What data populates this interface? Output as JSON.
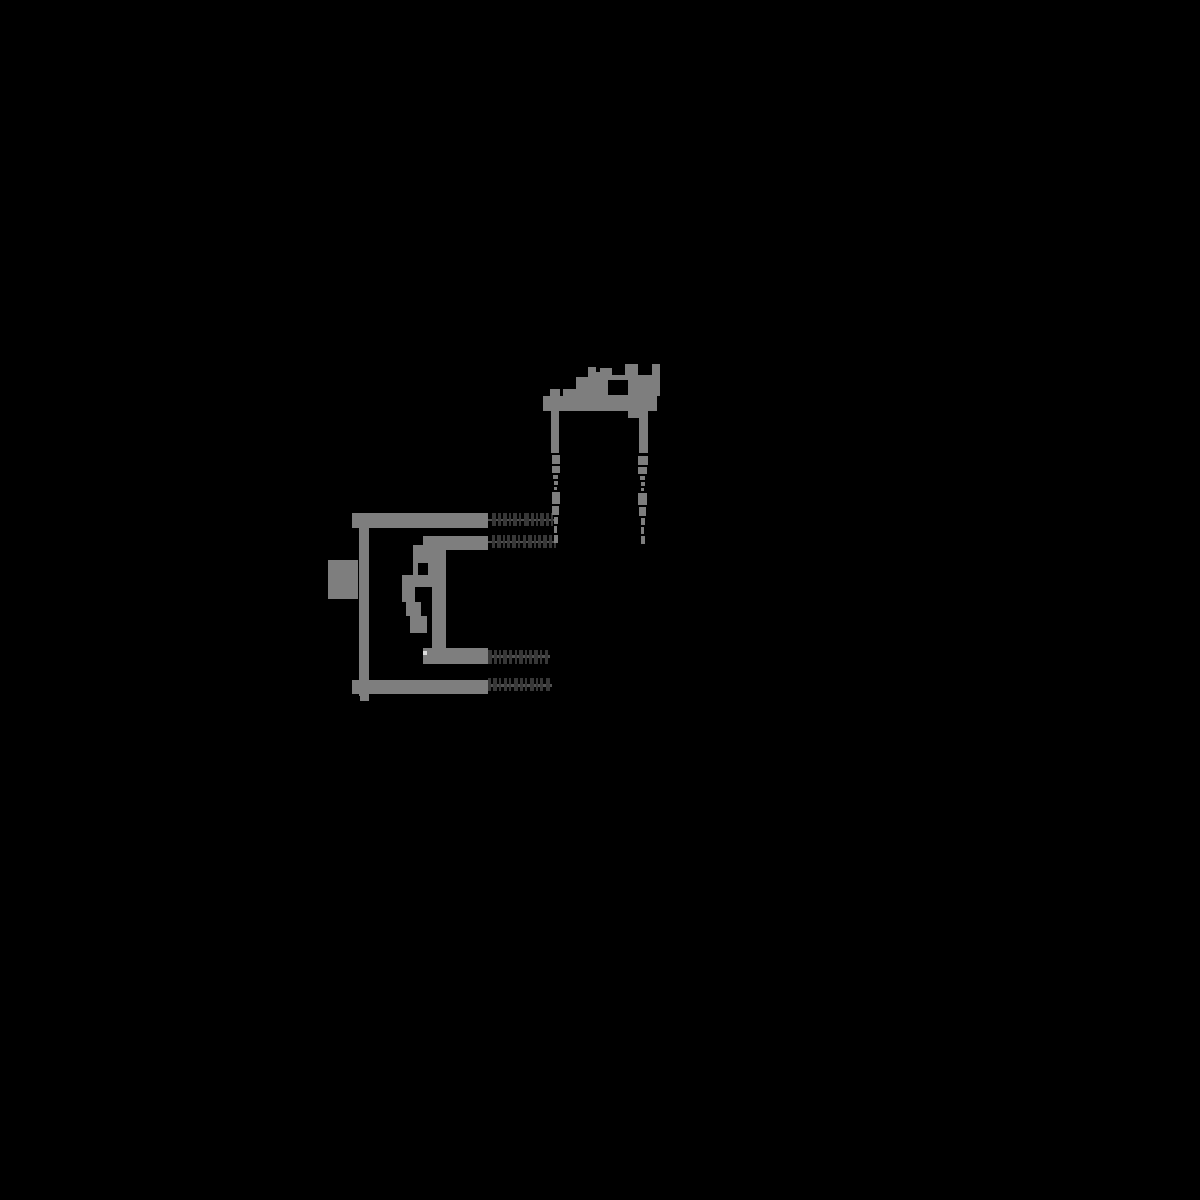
{
  "meta": {
    "description": "Pixelated phylogram on black background: four-tip phylogenetic tree drawn in mid-gray, illegible dark dashed tip labels, illegible blob node labels, and a top clade annotation with bracket and two dashed arrow drop-lines",
    "text_legible": false
  },
  "canvas": {
    "width": 1200,
    "height": 1200,
    "background": "#000000"
  },
  "palette": {
    "background": "#000000",
    "branch": "#7e7e7e",
    "dim_text": "#373737",
    "leader": "#515151",
    "dot": "#dcdcdc"
  },
  "tree": {
    "kind": "phylogram-left-to-right",
    "tip_count": 4,
    "topology_note": "tips 1 and 4 join the root stem directly; tips 2 and 3 form an inner clade on a vertical connector; node label text is illegible pixel blobs",
    "branch_rects": [
      {
        "n": "root-stem",
        "r": [
          359,
          513,
          10,
          183
        ]
      },
      {
        "n": "branch-tip1",
        "r": [
          352,
          513,
          136,
          15
        ]
      },
      {
        "n": "branch-tip2",
        "r": [
          423,
          536,
          65,
          14
        ]
      },
      {
        "n": "clade-connector",
        "r": [
          432,
          536,
          14,
          120
        ]
      },
      {
        "n": "branch-tip3",
        "r": [
          423,
          648,
          65,
          16
        ]
      },
      {
        "n": "branch-tip4",
        "r": [
          352,
          680,
          136,
          14
        ]
      },
      {
        "n": "stem-tail",
        "r": [
          360,
          694,
          9,
          7
        ]
      }
    ],
    "root_label_blob": [
      {
        "n": "root-label-blob",
        "r": [
          328,
          560,
          30,
          39
        ]
      }
    ],
    "internal_label_blob": [
      {
        "n": "node-label-blob-a",
        "r": [
          413,
          545,
          25,
          18
        ]
      },
      {
        "n": "node-label-blob-b",
        "r": [
          413,
          563,
          5,
          12
        ]
      },
      {
        "n": "node-label-blob-c",
        "r": [
          428,
          563,
          10,
          12
        ]
      },
      {
        "n": "node-label-blob-d",
        "r": [
          402,
          575,
          36,
          12
        ]
      },
      {
        "n": "node-label-blob-e",
        "r": [
          402,
          587,
          13,
          15
        ]
      },
      {
        "n": "node-label-blob-f",
        "r": [
          406,
          602,
          15,
          14
        ]
      },
      {
        "n": "node-label-blob-g",
        "r": [
          410,
          616,
          17,
          17
        ]
      }
    ],
    "highlight_dots": [
      {
        "n": "bright-node-dot",
        "r": [
          423,
          651,
          4,
          4
        ]
      }
    ],
    "tip_labels": [
      {
        "n": "tip-label-1",
        "legible": false,
        "x0": 490,
        "y": 513,
        "h": 13,
        "line": [
          488,
          519,
          66,
          2
        ],
        "segs": [
          [
            2,
            4
          ],
          [
            8,
            3
          ],
          [
            13,
            4
          ],
          [
            19,
            2
          ],
          [
            23,
            4
          ],
          [
            29,
            2
          ],
          [
            34,
            5
          ],
          [
            41,
            3
          ],
          [
            46,
            2
          ],
          [
            50,
            4
          ],
          [
            56,
            3
          ],
          [
            61,
            2
          ]
        ]
      },
      {
        "n": "tip-label-2",
        "legible": false,
        "x0": 490,
        "y": 535,
        "h": 13,
        "line": [
          488,
          541,
          68,
          2
        ],
        "segs": [
          [
            2,
            3
          ],
          [
            7,
            4
          ],
          [
            13,
            2
          ],
          [
            17,
            3
          ],
          [
            22,
            4
          ],
          [
            28,
            2
          ],
          [
            33,
            3
          ],
          [
            38,
            4
          ],
          [
            44,
            2
          ],
          [
            48,
            3
          ],
          [
            53,
            4
          ],
          [
            59,
            3
          ],
          [
            64,
            2
          ]
        ]
      },
      {
        "n": "tip-label-3",
        "legible": false,
        "x0": 488,
        "y": 650,
        "h": 14,
        "line": [
          488,
          655,
          62,
          3
        ],
        "segs": [
          [
            0,
            4
          ],
          [
            6,
            3
          ],
          [
            11,
            2
          ],
          [
            15,
            4
          ],
          [
            21,
            3
          ],
          [
            27,
            2
          ],
          [
            31,
            4
          ],
          [
            37,
            2
          ],
          [
            41,
            3
          ],
          [
            46,
            4
          ],
          [
            52,
            2
          ],
          [
            57,
            3
          ]
        ]
      },
      {
        "n": "tip-label-4",
        "legible": false,
        "x0": 488,
        "y": 678,
        "h": 13,
        "line": [
          488,
          684,
          64,
          3
        ],
        "segs": [
          [
            0,
            3
          ],
          [
            5,
            4
          ],
          [
            11,
            2
          ],
          [
            16,
            3
          ],
          [
            21,
            2
          ],
          [
            26,
            4
          ],
          [
            32,
            3
          ],
          [
            37,
            2
          ],
          [
            42,
            4
          ],
          [
            48,
            2
          ],
          [
            52,
            3
          ],
          [
            58,
            4
          ]
        ]
      }
    ]
  },
  "annotation": {
    "legible": false,
    "note": "illegible pixelated label above a bracket bar; two dashed vertical drop-lines with tapered arrow tips descend to y=545 at x=556 and x=643",
    "text_blocks": [
      {
        "n": "annotation-glyph-a",
        "r": [
          550,
          389,
          10,
          7
        ]
      },
      {
        "n": "annotation-glyph-b",
        "r": [
          563,
          389,
          13,
          7
        ]
      },
      {
        "n": "annotation-glyph-c",
        "r": [
          576,
          377,
          12,
          19
        ]
      },
      {
        "n": "annotation-glyph-d",
        "r": [
          588,
          367,
          8,
          29
        ]
      },
      {
        "n": "annotation-glyph-e",
        "r": [
          596,
          372,
          7,
          24
        ]
      },
      {
        "n": "annotation-glyph-f",
        "r": [
          600,
          368,
          12,
          28
        ]
      },
      {
        "n": "annotation-glyph-g",
        "r": [
          612,
          375,
          48,
          21
        ]
      },
      {
        "n": "annotation-glyph-h",
        "r": [
          625,
          364,
          13,
          32
        ]
      },
      {
        "n": "annotation-glyph-i",
        "r": [
          652,
          364,
          8,
          32
        ]
      },
      {
        "n": "annotation-bracket-bar",
        "r": [
          543,
          396,
          114,
          15
        ]
      },
      {
        "n": "annotation-leg-left",
        "r": [
          551,
          410,
          8,
          43
        ]
      },
      {
        "n": "annotation-leg-right",
        "r": [
          639,
          411,
          9,
          42
        ]
      },
      {
        "n": "annotation-bottom-tab",
        "r": [
          628,
          411,
          20,
          7
        ]
      }
    ],
    "holes": [
      {
        "n": "annotation-glyph-hole",
        "r": [
          608,
          380,
          20,
          15
        ]
      }
    ],
    "drop_lines": [
      {
        "n": "drop-line-left",
        "x": 552,
        "segments": [
          [
            455,
            9,
            8,
            0
          ],
          [
            466,
            7,
            8,
            0
          ],
          [
            475,
            4,
            5,
            1
          ],
          [
            481,
            4,
            4,
            2
          ],
          [
            487,
            3,
            3,
            2
          ],
          [
            492,
            12,
            8,
            0
          ],
          [
            506,
            9,
            7,
            0
          ],
          [
            517,
            7,
            4,
            2
          ],
          [
            526,
            7,
            3,
            2
          ],
          [
            535,
            8,
            4,
            2
          ]
        ]
      },
      {
        "n": "drop-line-right",
        "x": 638,
        "segments": [
          [
            456,
            9,
            10,
            0
          ],
          [
            467,
            7,
            9,
            0
          ],
          [
            476,
            4,
            5,
            2
          ],
          [
            482,
            4,
            4,
            3
          ],
          [
            488,
            3,
            3,
            3
          ],
          [
            493,
            12,
            9,
            0
          ],
          [
            507,
            9,
            7,
            1
          ],
          [
            518,
            7,
            4,
            3
          ],
          [
            527,
            7,
            3,
            3
          ],
          [
            536,
            8,
            4,
            3
          ]
        ]
      }
    ]
  }
}
